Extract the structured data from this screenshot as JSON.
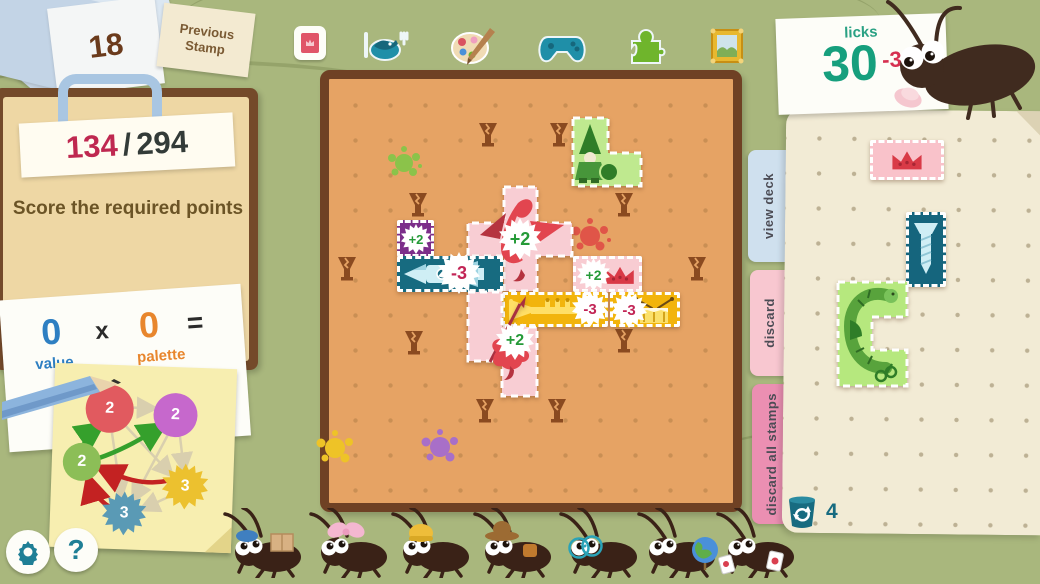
{
  "previous_stamp": {
    "count": "18",
    "label": "Previous Stamp"
  },
  "score": {
    "current": "134",
    "separator": "/",
    "total": "294",
    "objective": "Score the required points"
  },
  "formula": {
    "value": "0",
    "value_label": "value",
    "times": "x",
    "palette": "0",
    "palette_label": "palette",
    "equals": "="
  },
  "combo_diagram": {
    "nodes": [
      {
        "shape": "flower",
        "color": "#e15a5f",
        "value": "2"
      },
      {
        "shape": "flower",
        "color": "#c668cc",
        "value": "2"
      },
      {
        "shape": "circle",
        "color": "#8cbe57",
        "value": "2"
      },
      {
        "shape": "burst",
        "color": "#ecc12f",
        "value": "3"
      },
      {
        "shape": "burst",
        "color": "#5a9ab5",
        "value": "3"
      }
    ]
  },
  "top_tabs": {
    "icons": [
      "stamp-album",
      "food",
      "art",
      "games",
      "toys",
      "pictures"
    ]
  },
  "licks": {
    "label": "licks",
    "count": "30",
    "delta": "-3"
  },
  "board": {
    "badges": {
      "purple_square": "+2",
      "dragon": "+2",
      "rocket": "-3",
      "crown": "+2",
      "trumpet": "-3",
      "drum": "-3",
      "spear_dragon": "+2"
    }
  },
  "right_panel": {
    "tabs": [
      {
        "label": "view deck"
      },
      {
        "label": "discard"
      },
      {
        "label": "discard all stamps"
      }
    ],
    "redraw_count": "4"
  },
  "footer": {
    "help": "?"
  },
  "bugs": {
    "accessories": [
      "package",
      "bow",
      "beanie",
      "cowboy-hat",
      "glasses",
      "globe",
      "cards"
    ]
  },
  "colors": {
    "accent_teal": "#1a9e7e",
    "accent_red": "#d62f50",
    "board": "#e6a364",
    "background": "#a9b77d"
  }
}
